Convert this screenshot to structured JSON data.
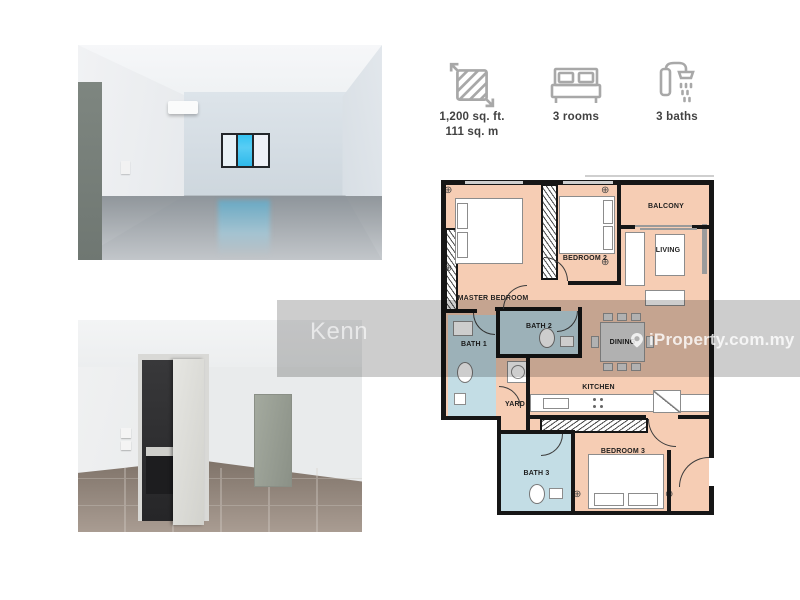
{
  "stats": {
    "area": {
      "icon": "area-measure-icon",
      "value_imperial": "1,200 sq. ft.",
      "value_metric": "111 sq. m"
    },
    "rooms": {
      "icon": "bed-icon",
      "label": "3 rooms"
    },
    "baths": {
      "icon": "shower-icon",
      "label": "3 baths"
    }
  },
  "floor_plan": {
    "labels": {
      "master_bedroom": "MASTER BEDROOM",
      "bedroom2": "BEDROOM 2",
      "bedroom3": "BEDROOM 3",
      "balcony": "BALCONY",
      "living": "LIVING",
      "dining": "DINING",
      "kitchen": "KITCHEN",
      "yard": "YARD",
      "bath1": "BATH 1",
      "bath2": "BATH 2",
      "bath3": "BATH 3"
    },
    "colors": {
      "room": "#f6cdb4",
      "bath": "#c3dde5",
      "wall": "#161616"
    }
  },
  "watermarks": {
    "agent": "Kenn",
    "brand": "iProperty.com.my"
  }
}
